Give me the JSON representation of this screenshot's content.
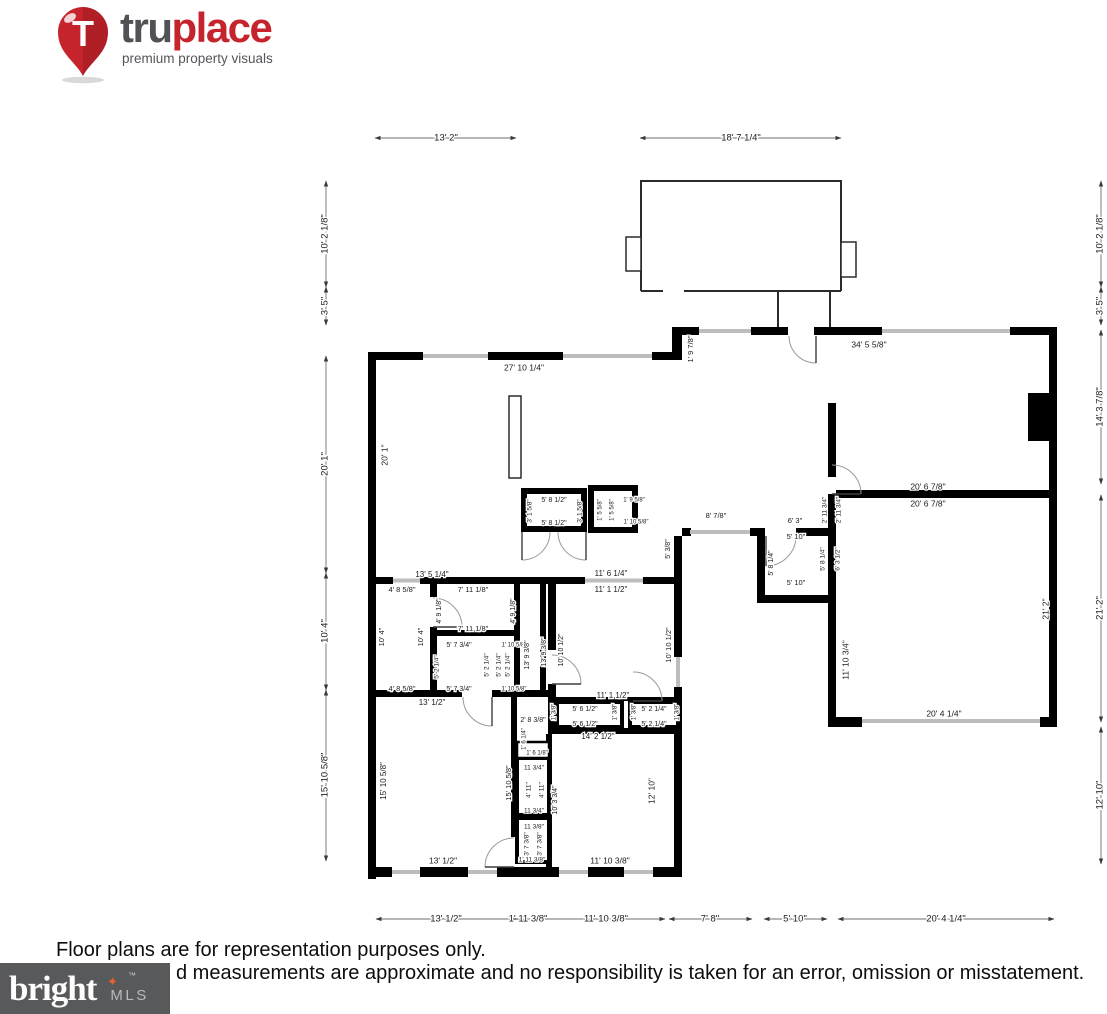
{
  "header": {
    "pin_letter": "T",
    "brand_tru": "tru",
    "brand_place": "place",
    "tagline": "premium property visuals"
  },
  "footer": {
    "line1": "Floor plans are for representation purposes only.",
    "line2_visible": "d measurements are approximate and no responsibility is taken for an error, omission or misstatement.",
    "mls_brand": "bright",
    "mls_tm": "™",
    "mls_star": "✦",
    "mls_suffix": "MLS"
  },
  "colors": {
    "brand_red": "#c6242d",
    "brand_gray": "#515255",
    "mls_box": "#58595b",
    "mls_accent": "#e8622d",
    "wall": "#000000",
    "window": "#bdbdbd"
  },
  "plan": {
    "labels": [
      {
        "t": "13' 2\"",
        "x": 446,
        "y": 138,
        "s": 9.5
      },
      {
        "t": "18' 7 1/4\"",
        "x": 741,
        "y": 138,
        "s": 9.5
      },
      {
        "t": "10' 2 1/8\"",
        "x": 325,
        "y": 234,
        "r": -90,
        "s": 9.5
      },
      {
        "t": "3' 5\"",
        "x": 325,
        "y": 306,
        "r": -90,
        "s": 9.5
      },
      {
        "t": "20' 1\"",
        "x": 325,
        "y": 464,
        "r": -90,
        "s": 9.5
      },
      {
        "t": "10' 4\"",
        "x": 325,
        "y": 631,
        "r": -90,
        "s": 9.5
      },
      {
        "t": "15' 10 5/8\"",
        "x": 325,
        "y": 775,
        "r": -90,
        "s": 9.5
      },
      {
        "t": "10' 2 1/8\"",
        "x": 1100,
        "y": 234,
        "r": -90,
        "s": 9.5
      },
      {
        "t": "3' 5\"",
        "x": 1100,
        "y": 306,
        "r": -90,
        "s": 9.5
      },
      {
        "t": "14' 3 7/8\"",
        "x": 1100,
        "y": 407,
        "r": -90,
        "s": 9.5
      },
      {
        "t": "21' 2\"",
        "x": 1100,
        "y": 608,
        "r": -90,
        "s": 9.5
      },
      {
        "t": "12' 10\"",
        "x": 1100,
        "y": 795,
        "r": -90,
        "s": 9.5
      },
      {
        "t": "13' 1/2\"",
        "x": 446,
        "y": 919,
        "s": 9.5
      },
      {
        "t": "1' 11 3/8\"",
        "x": 528,
        "y": 919,
        "s": 9.5
      },
      {
        "t": "11' 10 3/8\"",
        "x": 606,
        "y": 919,
        "s": 9.5
      },
      {
        "t": "7' 8\"",
        "x": 710,
        "y": 919,
        "s": 9.5
      },
      {
        "t": "5' 10\"",
        "x": 795,
        "y": 919,
        "s": 9.5
      },
      {
        "t": "20' 4 1/4\"",
        "x": 946,
        "y": 919,
        "s": 9.5
      },
      {
        "t": "27' 10 1/4\"",
        "x": 524,
        "y": 368,
        "s": 8.5
      },
      {
        "t": "34' 5 5/8\"",
        "x": 869,
        "y": 345,
        "s": 8.5
      },
      {
        "t": "1' 9 7/8\"",
        "x": 691,
        "y": 349,
        "r": -90,
        "s": 7.5
      },
      {
        "t": "20' 1\"",
        "x": 385,
        "y": 455,
        "r": -90,
        "s": 8.5
      },
      {
        "t": "3' 1 5/8\"",
        "x": 530,
        "y": 511,
        "r": -90,
        "s": 6.5
      },
      {
        "t": "5' 8 1/2\"",
        "x": 554,
        "y": 500,
        "s": 7
      },
      {
        "t": "5' 8 1/2\"",
        "x": 554,
        "y": 523,
        "s": 7
      },
      {
        "t": "3' 1 5/8\"",
        "x": 580,
        "y": 511,
        "r": -90,
        "s": 6.5
      },
      {
        "t": "1' 5 5/8\"",
        "x": 600,
        "y": 510,
        "r": -90,
        "s": 6
      },
      {
        "t": "1' 5 5/8\"",
        "x": 612,
        "y": 510,
        "r": -90,
        "s": 6
      },
      {
        "t": "1' 9 5/8\"",
        "x": 634,
        "y": 500,
        "s": 6
      },
      {
        "t": "1' 10 5/8\"",
        "x": 636,
        "y": 522,
        "s": 6
      },
      {
        "t": "5' 3/8\"",
        "x": 668,
        "y": 549,
        "r": -90,
        "s": 7
      },
      {
        "t": "8' 7/8\"",
        "x": 716,
        "y": 516,
        "s": 7.5
      },
      {
        "t": "6' 3\"",
        "x": 795,
        "y": 521,
        "s": 7.5
      },
      {
        "t": "5' 10\"",
        "x": 796,
        "y": 537,
        "s": 7.5
      },
      {
        "t": "5' 8 1/4\"",
        "x": 771,
        "y": 563,
        "r": -90,
        "s": 7
      },
      {
        "t": "5' 10\"",
        "x": 796,
        "y": 583,
        "s": 7.5
      },
      {
        "t": "2' 11 3/4\"",
        "x": 825,
        "y": 510,
        "r": -90,
        "s": 6.5
      },
      {
        "t": "2' 11 3/4\"",
        "x": 839,
        "y": 510,
        "r": -90,
        "s": 6.5
      },
      {
        "t": "5' 8 1/4\"",
        "x": 823,
        "y": 559,
        "r": -90,
        "s": 6.5
      },
      {
        "t": "6' 3 1/2\"",
        "x": 838,
        "y": 559,
        "r": -90,
        "s": 6.5
      },
      {
        "t": "20' 6 7/8\"",
        "x": 928,
        "y": 487,
        "s": 8.5
      },
      {
        "t": "20' 6 7/8\"",
        "x": 928,
        "y": 504,
        "s": 8.5
      },
      {
        "t": "21' 2\"",
        "x": 1046,
        "y": 609,
        "r": -90,
        "s": 8.5
      },
      {
        "t": "11' 10 3/4\"",
        "x": 846,
        "y": 660,
        "r": -90,
        "s": 8.5
      },
      {
        "t": "20' 4 1/4\"",
        "x": 944,
        "y": 714,
        "s": 8.5
      },
      {
        "t": "13' 5 1/4\"",
        "x": 432,
        "y": 575,
        "s": 8
      },
      {
        "t": "4' 8 5/8\"",
        "x": 402,
        "y": 590,
        "s": 7.5
      },
      {
        "t": "7' 11 1/8\"",
        "x": 473,
        "y": 590,
        "s": 7.5
      },
      {
        "t": "4' 9 1/8\"",
        "x": 439,
        "y": 611,
        "r": -90,
        "s": 7
      },
      {
        "t": "4' 9 1/8\"",
        "x": 513,
        "y": 611,
        "r": -90,
        "s": 7
      },
      {
        "t": "7' 11 1/8\"",
        "x": 473,
        "y": 629,
        "s": 7.5
      },
      {
        "t": "10' 4\"",
        "x": 382,
        "y": 637,
        "r": -90,
        "s": 7.5
      },
      {
        "t": "10' 4\"",
        "x": 421,
        "y": 637,
        "r": -90,
        "s": 7.5
      },
      {
        "t": "5' 7 3/4\"",
        "x": 459,
        "y": 645,
        "s": 7
      },
      {
        "t": "1' 10 5/8\"",
        "x": 514,
        "y": 645,
        "s": 6
      },
      {
        "t": "5' 2 1/4\"",
        "x": 437,
        "y": 667,
        "r": -90,
        "s": 6.5
      },
      {
        "t": "5' 2 1/4\"",
        "x": 487,
        "y": 665,
        "r": -90,
        "s": 6.5
      },
      {
        "t": "5' 2 1/4\"",
        "x": 499,
        "y": 665,
        "r": -90,
        "s": 6.5
      },
      {
        "t": "5' 2 1/4\"",
        "x": 508,
        "y": 665,
        "r": -90,
        "s": 6.5
      },
      {
        "t": "13' 9 3/8\"",
        "x": 527,
        "y": 655,
        "r": -90,
        "s": 7
      },
      {
        "t": "13' 9 3/8\"",
        "x": 544,
        "y": 652,
        "r": -90,
        "s": 7
      },
      {
        "t": "10' 10 1/2\"",
        "x": 561,
        "y": 650,
        "r": -90,
        "s": 7
      },
      {
        "t": "10' 10 1/2\"",
        "x": 669,
        "y": 645,
        "r": -90,
        "s": 7.5
      },
      {
        "t": "4' 8 5/8\"",
        "x": 402,
        "y": 689,
        "s": 7.5
      },
      {
        "t": "5' 7 3/4\"",
        "x": 459,
        "y": 689,
        "s": 7
      },
      {
        "t": "1' 10 5/8\"",
        "x": 514,
        "y": 689,
        "s": 6
      },
      {
        "t": "13' 1/2\"",
        "x": 432,
        "y": 703,
        "s": 8
      },
      {
        "t": "11' 6 1/4\"",
        "x": 611,
        "y": 574,
        "s": 8
      },
      {
        "t": "11' 1 1/2\"",
        "x": 611,
        "y": 590,
        "s": 8
      },
      {
        "t": "11' 1 1/2\"",
        "x": 613,
        "y": 696,
        "s": 8
      },
      {
        "t": "2' 8 3/8\"",
        "x": 533,
        "y": 720,
        "s": 7
      },
      {
        "t": "1' 3/8\"",
        "x": 554,
        "y": 712,
        "r": -90,
        "s": 6
      },
      {
        "t": "5' 6 1/2\"",
        "x": 585,
        "y": 709,
        "s": 7
      },
      {
        "t": "5' 6 1/2\"",
        "x": 585,
        "y": 724,
        "s": 7
      },
      {
        "t": "1' 3/8\"",
        "x": 615,
        "y": 712,
        "r": -90,
        "s": 6
      },
      {
        "t": "1' 3/8\"",
        "x": 634,
        "y": 712,
        "r": -90,
        "s": 6
      },
      {
        "t": "5' 2 1/4\"",
        "x": 654,
        "y": 709,
        "s": 7
      },
      {
        "t": "5' 2 1/4\"",
        "x": 654,
        "y": 724,
        "s": 7
      },
      {
        "t": "1' 3/8\"",
        "x": 677,
        "y": 712,
        "r": -90,
        "s": 6
      },
      {
        "t": "14' 2 1/2\"",
        "x": 598,
        "y": 737,
        "s": 8
      },
      {
        "t": "1' 6 1/4\"",
        "x": 524,
        "y": 739,
        "r": -90,
        "s": 6
      },
      {
        "t": "1' 6 1/8\"",
        "x": 537,
        "y": 753,
        "s": 6
      },
      {
        "t": "15' 10 5/8\"",
        "x": 384,
        "y": 781,
        "r": -90,
        "s": 8
      },
      {
        "t": "15' 10 5/8\"",
        "x": 509,
        "y": 783,
        "r": -90,
        "s": 7.5
      },
      {
        "t": "11 3/4\"",
        "x": 534,
        "y": 768,
        "s": 6.5
      },
      {
        "t": "4' 11\"",
        "x": 529,
        "y": 790,
        "r": -90,
        "s": 6.5
      },
      {
        "t": "4' 11\"",
        "x": 542,
        "y": 790,
        "r": -90,
        "s": 6.5
      },
      {
        "t": "11 3/4\"",
        "x": 534,
        "y": 811,
        "s": 6.5
      },
      {
        "t": "10' 3 3/4\"",
        "x": 555,
        "y": 800,
        "r": -90,
        "s": 7
      },
      {
        "t": "11 3/8\"",
        "x": 534,
        "y": 827,
        "s": 6.5
      },
      {
        "t": "3' 7 3/8\"",
        "x": 527,
        "y": 844,
        "r": -90,
        "s": 6.5
      },
      {
        "t": "3' 7 3/8\"",
        "x": 540,
        "y": 844,
        "r": -90,
        "s": 6.5
      },
      {
        "t": "1' 11 3/8\"",
        "x": 532,
        "y": 860,
        "s": 6.5
      },
      {
        "t": "12' 10\"",
        "x": 652,
        "y": 791,
        "r": -90,
        "s": 8.5
      },
      {
        "t": "13' 1/2\"",
        "x": 443,
        "y": 861,
        "s": 8.5
      },
      {
        "t": "11' 10 3/8\"",
        "x": 610,
        "y": 861,
        "s": 8.5
      }
    ]
  }
}
